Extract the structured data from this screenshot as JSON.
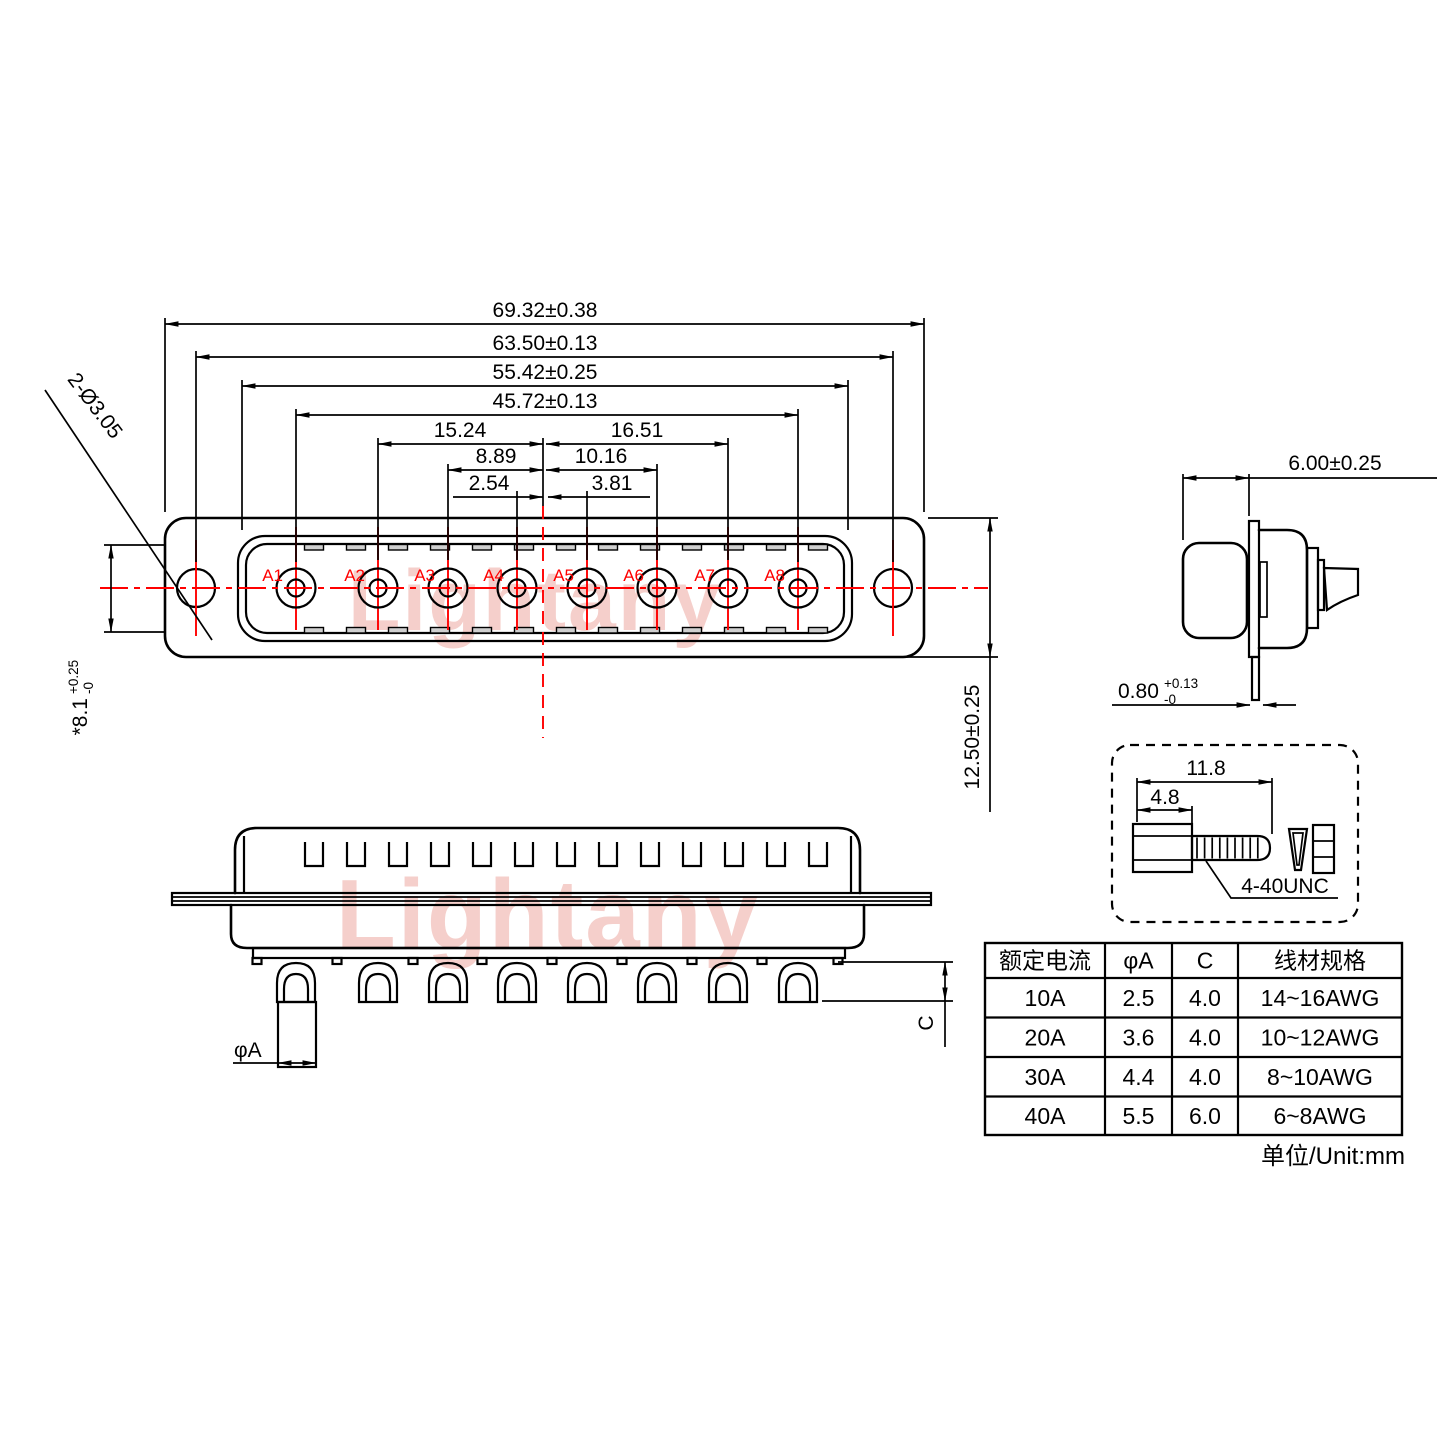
{
  "watermark": {
    "text": "Lightany"
  },
  "front_view": {
    "pin_labels": [
      "A1",
      "A2",
      "A3",
      "A4",
      "A5",
      "A6",
      "A7",
      "A8"
    ]
  },
  "dims": {
    "overall_width": "69.32±0.38",
    "mount_span": "63.50±0.13",
    "shell_width": "55.42±0.25",
    "pin_span": "45.72±0.13",
    "a2_to_center": "15.24",
    "center_to_a7": "16.51",
    "a3_to_center": "8.89",
    "center_to_a6": "10.16",
    "a4_to_center": "2.54",
    "center_to_a5": "3.81",
    "mount_holes": "2-Ø3.05",
    "opening_height": "*8.1",
    "opening_height_tol_up": "+0.25",
    "opening_height_tol_dn": "-0",
    "flange_height": "12.50±0.25",
    "body_depth": "6.00±0.25",
    "flange_thickness": "0.80",
    "flange_thickness_tol_up": "+0.13",
    "flange_thickness_tol_dn": "-0",
    "pin_dia_label": "φA",
    "tail_length_label": "C"
  },
  "screw_detail": {
    "length_total": "11.8",
    "length_head": "4.8",
    "thread_spec": "4-40UNC"
  },
  "spec_table": {
    "headers": [
      "额定电流",
      "φA",
      "C",
      "线材规格"
    ],
    "rows": [
      [
        "10A",
        "2.5",
        "4.0",
        "14~16AWG"
      ],
      [
        "20A",
        "3.6",
        "4.0",
        "10~12AWG"
      ],
      [
        "30A",
        "4.4",
        "4.0",
        "8~10AWG"
      ],
      [
        "40A",
        "5.5",
        "6.0",
        "6~8AWG"
      ]
    ],
    "unit_note": "单位/Unit:mm"
  }
}
